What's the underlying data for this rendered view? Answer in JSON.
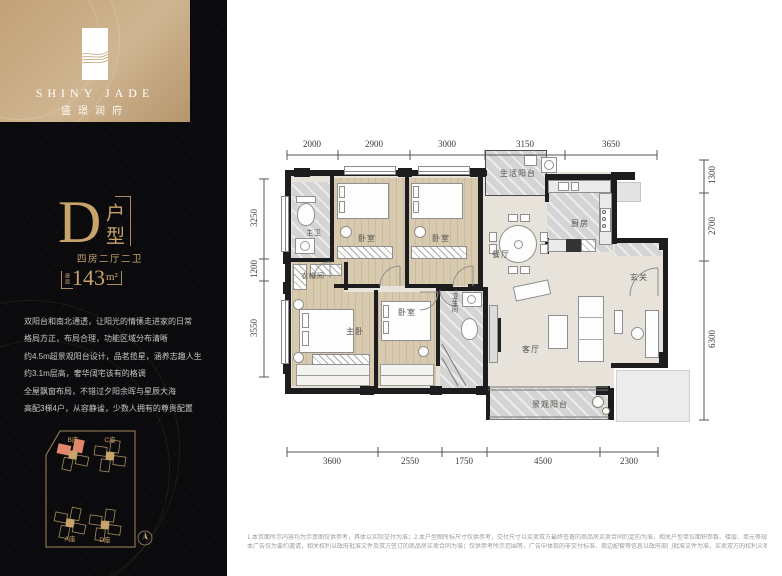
{
  "brand": {
    "name_en": "SHINY JADE",
    "name_cn": "盛璟润府"
  },
  "unit": {
    "letter": "D",
    "type_label": "户型",
    "layout": "四房二厅二卫",
    "area_prefix": "建面",
    "area_value": "143",
    "area_unit": "m²"
  },
  "description_lines": [
    "双阳台和南北通透，让阳光的情愫走进家的日常",
    "格局方正，布局合理，功能区域分布清晰",
    "约4.5m超景观阳台设计，品茗揽星，涵养志趣人生",
    "约3.1m层高，奢华阔宅该有的格调",
    "全屋飘窗布局，不错过夕阳余晖与星辰大海",
    "高配3梯4户，从容静谧，少数人拥有的尊贵配置"
  ],
  "site_plan": {
    "buildings": [
      {
        "id": "B座",
        "highlighted": true
      },
      {
        "id": "C座",
        "highlighted": false
      },
      {
        "id": "A座",
        "highlighted": false
      },
      {
        "id": "D座",
        "highlighted": false
      }
    ]
  },
  "floor_plan": {
    "rooms": [
      {
        "name": "生活阳台"
      },
      {
        "name": "厨房"
      },
      {
        "name": "餐厅"
      },
      {
        "name": "玄关"
      },
      {
        "name": "主卫"
      },
      {
        "name": "卧室"
      },
      {
        "name": "卧室"
      },
      {
        "name": "衣帽间"
      },
      {
        "name": "主卧"
      },
      {
        "name": "卧室"
      },
      {
        "name": "卫生间"
      },
      {
        "name": "客厅"
      },
      {
        "name": "景观阳台"
      }
    ],
    "dimensions": {
      "top": [
        "2000",
        "2900",
        "3000",
        "3150",
        "3650"
      ],
      "bottom": [
        "3600",
        "2550",
        "1750",
        "4500",
        "2300"
      ],
      "left": [
        "3250",
        "1200",
        "3550"
      ],
      "right": [
        "1300",
        "2700",
        "6300"
      ]
    }
  },
  "footer": {
    "line1": "1.本页面所示内容均为示意图仅供参考，具体以实际交付为准；2.本户型图所标尺寸仅供参考，交付尺寸以买卖双方最终签署的商品房买卖合同约定的为准，相关户型单位面积参数、楼层、单元等规划、房屋结构、面积等可能不同；3.本图标示家具、电器等仅为布置参考，非交付标准；4.本户型图仅为参考示意图，最终以户内实际情况为准，",
    "line2": "本广告仅为要约邀请，相关权利以政府批准文件及双方签订的商品房买卖合同为准；仅供参考所示范围等，广告中体现的非交付标准、周边配套等信息以政府部门批准文件为准，买卖双方的权利义务以双方签订的商品房买卖合同为准，相关内容如有变动，请以最新资料为准，制作时间：2021年6月"
  },
  "colors": {
    "gold": "#c8a36b",
    "highlight": "#e0876c",
    "sidebar_bg": "#0b0b0e",
    "wall": "#1d1d1f"
  }
}
